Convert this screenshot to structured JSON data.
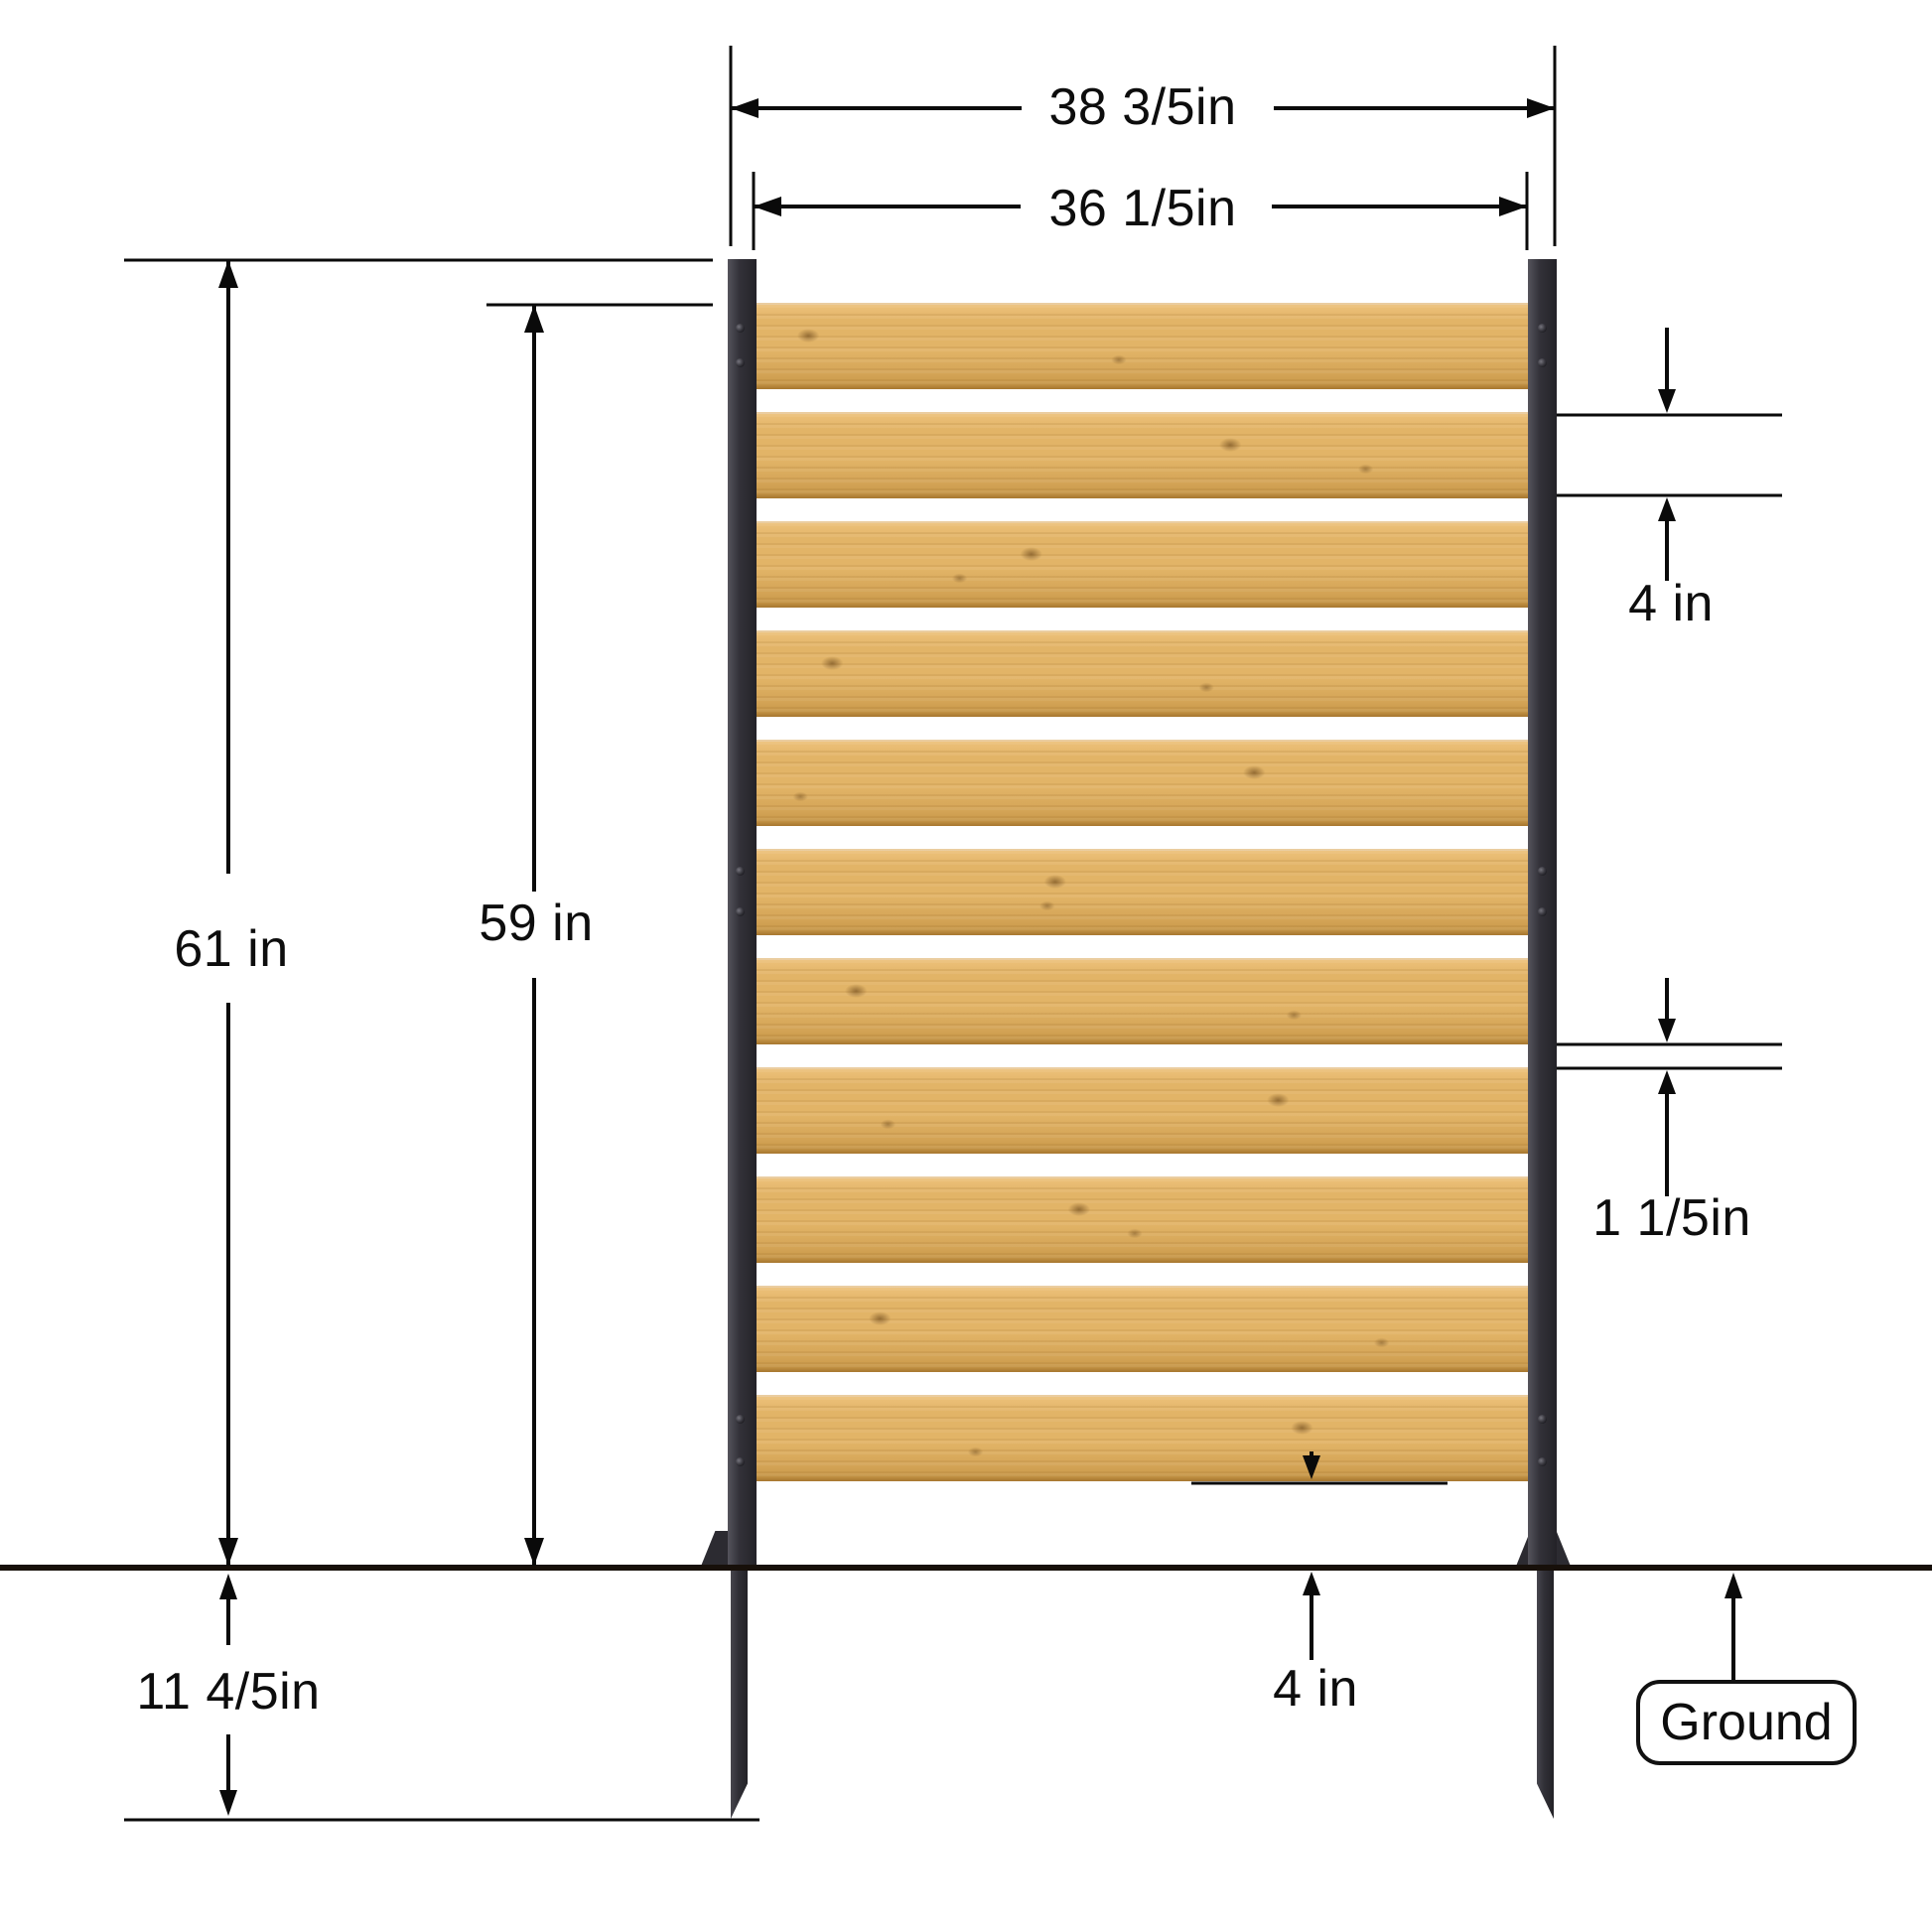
{
  "diagram": {
    "title": "Fence panel dimension diagram",
    "labels": {
      "outer_width": "38 3/5in",
      "panel_width": "36 1/5in",
      "post_height": "61 in",
      "slat_top_height": "59 in",
      "slat_width": "4 in",
      "slat_gap": "1 1/5in",
      "bottom_clearance": "4 in",
      "stake_depth": "11 4/5in",
      "ground": "Ground"
    },
    "colors": {
      "wood_light": "#eec27c",
      "wood": "#e2b467",
      "wood_shade": "#d3a355",
      "wood_dark": "#c39343",
      "knot": "#5a370f",
      "post": "#33323a",
      "line": "#0a0a0a",
      "ground_line": "#17100a",
      "background": "#ffffff"
    },
    "fence": {
      "slat_count": 11,
      "bolt_rows_y": [
        330,
        365,
        877,
        918,
        1429,
        1472
      ]
    }
  }
}
